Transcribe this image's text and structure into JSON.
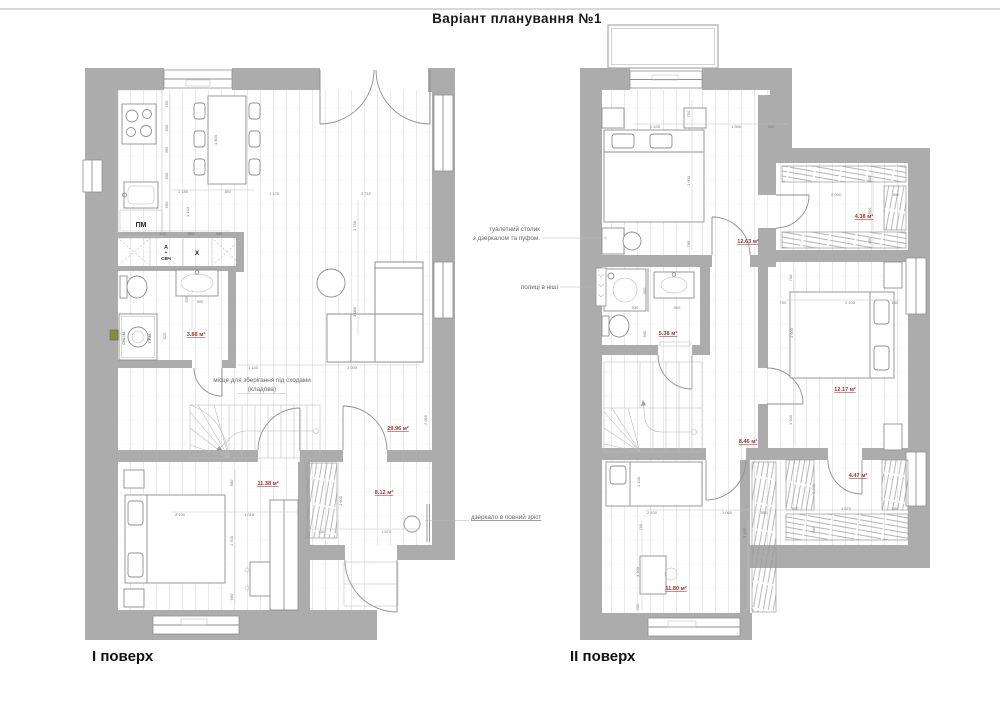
{
  "header": {
    "title": "Варіант планування №1"
  },
  "footer": {
    "floor1": "І поверх",
    "floor2": "ІІ поверх"
  },
  "notes": {
    "storage1": "місце для зберігання під сходами",
    "storage2": "(кладова)",
    "dress1": "туалетний столик",
    "dress2": "з дзеркалом та пуфом.",
    "shelves": "полиці в ніші",
    "mirror": "дзеркало в повний зріст"
  },
  "labels": {
    "pm": "ПМ",
    "d": "Д",
    "plus": "+",
    "svch": "СВЧ",
    "x": "Х",
    "sush": "СУШ.М.",
    "pr": "ПР.М."
  },
  "areas": {
    "floor1": [
      {
        "t": "3.88 м²",
        "x": 196,
        "y": 336
      },
      {
        "t": "29.96 м²",
        "x": 398,
        "y": 430
      },
      {
        "t": "11.38 м²",
        "x": 268,
        "y": 485
      },
      {
        "t": "8.12 м²",
        "x": 384,
        "y": 494
      }
    ],
    "floor2": [
      {
        "t": "12.63 м²",
        "x": 748,
        "y": 243
      },
      {
        "t": "4.38 м²",
        "x": 864,
        "y": 218
      },
      {
        "t": "5.38 м²",
        "x": 668,
        "y": 335
      },
      {
        "t": "12.17 м²",
        "x": 845,
        "y": 391
      },
      {
        "t": "8.46 м²",
        "x": 748,
        "y": 443
      },
      {
        "t": "4.47 м²",
        "x": 858,
        "y": 477
      },
      {
        "t": "11.80 м²",
        "x": 676,
        "y": 590
      }
    ]
  },
  "dimensions": {
    "floor1": [
      {
        "t": "750",
        "x": 168,
        "y": 104,
        "r": 1
      },
      {
        "t": "600",
        "x": 168,
        "y": 128,
        "r": 1
      },
      {
        "t": "365",
        "x": 168,
        "y": 150,
        "r": 1
      },
      {
        "t": "600",
        "x": 168,
        "y": 176,
        "r": 1
      },
      {
        "t": "600",
        "x": 168,
        "y": 205,
        "r": 1
      },
      {
        "t": "1 800",
        "x": 217,
        "y": 140,
        "r": 1
      },
      {
        "t": "1 180",
        "x": 183,
        "y": 193
      },
      {
        "t": "800",
        "x": 228,
        "y": 193
      },
      {
        "t": "1 144",
        "x": 189,
        "y": 212,
        "r": 1
      },
      {
        "t": "600",
        "x": 163,
        "y": 235
      },
      {
        "t": "600",
        "x": 191,
        "y": 235
      },
      {
        "t": "345",
        "x": 219,
        "y": 235
      },
      {
        "t": "935",
        "x": 188,
        "y": 299,
        "r": 1
      },
      {
        "t": "900",
        "x": 200,
        "y": 303
      },
      {
        "t": "620",
        "x": 166,
        "y": 336,
        "r": 1
      },
      {
        "t": "1 125",
        "x": 274,
        "y": 195
      },
      {
        "t": "2 710",
        "x": 366,
        "y": 195
      },
      {
        "t": "1 730",
        "x": 356,
        "y": 226,
        "r": 1
      },
      {
        "t": "3 080",
        "x": 356,
        "y": 312,
        "r": 1
      },
      {
        "t": "1 143",
        "x": 253,
        "y": 369
      },
      {
        "t": "3 000",
        "x": 352,
        "y": 369
      },
      {
        "t": "2 055",
        "x": 427,
        "y": 420,
        "r": 1
      },
      {
        "t": "2 100",
        "x": 180,
        "y": 516
      },
      {
        "t": "1 010",
        "x": 249,
        "y": 516
      },
      {
        "t": "680",
        "x": 233,
        "y": 483,
        "r": 1
      },
      {
        "t": "1 700",
        "x": 233,
        "y": 541,
        "r": 1
      },
      {
        "t": "680",
        "x": 233,
        "y": 597,
        "r": 1
      },
      {
        "t": "1 605",
        "x": 342,
        "y": 501,
        "r": 1
      },
      {
        "t": "600",
        "x": 322,
        "y": 533
      },
      {
        "t": "1 870",
        "x": 386,
        "y": 533
      }
    ],
    "floor2": [
      {
        "t": "2 100",
        "x": 655,
        "y": 128
      },
      {
        "t": "750",
        "x": 690,
        "y": 114,
        "r": 1
      },
      {
        "t": "1 305",
        "x": 736,
        "y": 128
      },
      {
        "t": "300",
        "x": 771,
        "y": 128
      },
      {
        "t": "1 900",
        "x": 690,
        "y": 181,
        "r": 1
      },
      {
        "t": "785",
        "x": 690,
        "y": 244,
        "r": 1
      },
      {
        "t": "2 090",
        "x": 836,
        "y": 196
      },
      {
        "t": "500",
        "x": 896,
        "y": 196
      },
      {
        "t": "400",
        "x": 871,
        "y": 179,
        "r": 1
      },
      {
        "t": "800",
        "x": 871,
        "y": 211,
        "r": 1
      },
      {
        "t": "400",
        "x": 871,
        "y": 241,
        "r": 1
      },
      {
        "t": "930",
        "x": 635,
        "y": 309
      },
      {
        "t": "900",
        "x": 677,
        "y": 309
      },
      {
        "t": "950",
        "x": 646,
        "y": 291,
        "r": 1
      },
      {
        "t": "900",
        "x": 646,
        "y": 334,
        "r": 1
      },
      {
        "t": "740",
        "x": 792,
        "y": 278,
        "r": 1
      },
      {
        "t": "700",
        "x": 783,
        "y": 304
      },
      {
        "t": "2 100",
        "x": 850,
        "y": 304
      },
      {
        "t": "140",
        "x": 895,
        "y": 304
      },
      {
        "t": "1 900",
        "x": 793,
        "y": 333,
        "r": 1
      },
      {
        "t": "1 500",
        "x": 792,
        "y": 420,
        "r": 1
      },
      {
        "t": "1 100",
        "x": 640,
        "y": 482,
        "r": 1
      },
      {
        "t": "2 100",
        "x": 652,
        "y": 514
      },
      {
        "t": "1 060",
        "x": 727,
        "y": 514
      },
      {
        "t": "550",
        "x": 764,
        "y": 514
      },
      {
        "t": "500",
        "x": 795,
        "y": 510
      },
      {
        "t": "1 570",
        "x": 846,
        "y": 510
      },
      {
        "t": "500",
        "x": 895,
        "y": 510
      },
      {
        "t": "1 240",
        "x": 815,
        "y": 489,
        "r": 1
      },
      {
        "t": "900",
        "x": 815,
        "y": 530,
        "r": 1
      },
      {
        "t": "795",
        "x": 642,
        "y": 527,
        "r": 1
      },
      {
        "t": "1 200",
        "x": 639,
        "y": 572,
        "r": 1
      },
      {
        "t": "200",
        "x": 639,
        "y": 607,
        "r": 1
      },
      {
        "t": "3 195",
        "x": 746,
        "y": 533,
        "r": 1
      }
    ]
  },
  "colors": {
    "wall_gray": "#acacac",
    "area_red": "#a6342c",
    "dim_gray": "#7a7a7a",
    "line_gray": "#8f8f8f",
    "accent_yellow": "#8b8b3a"
  }
}
